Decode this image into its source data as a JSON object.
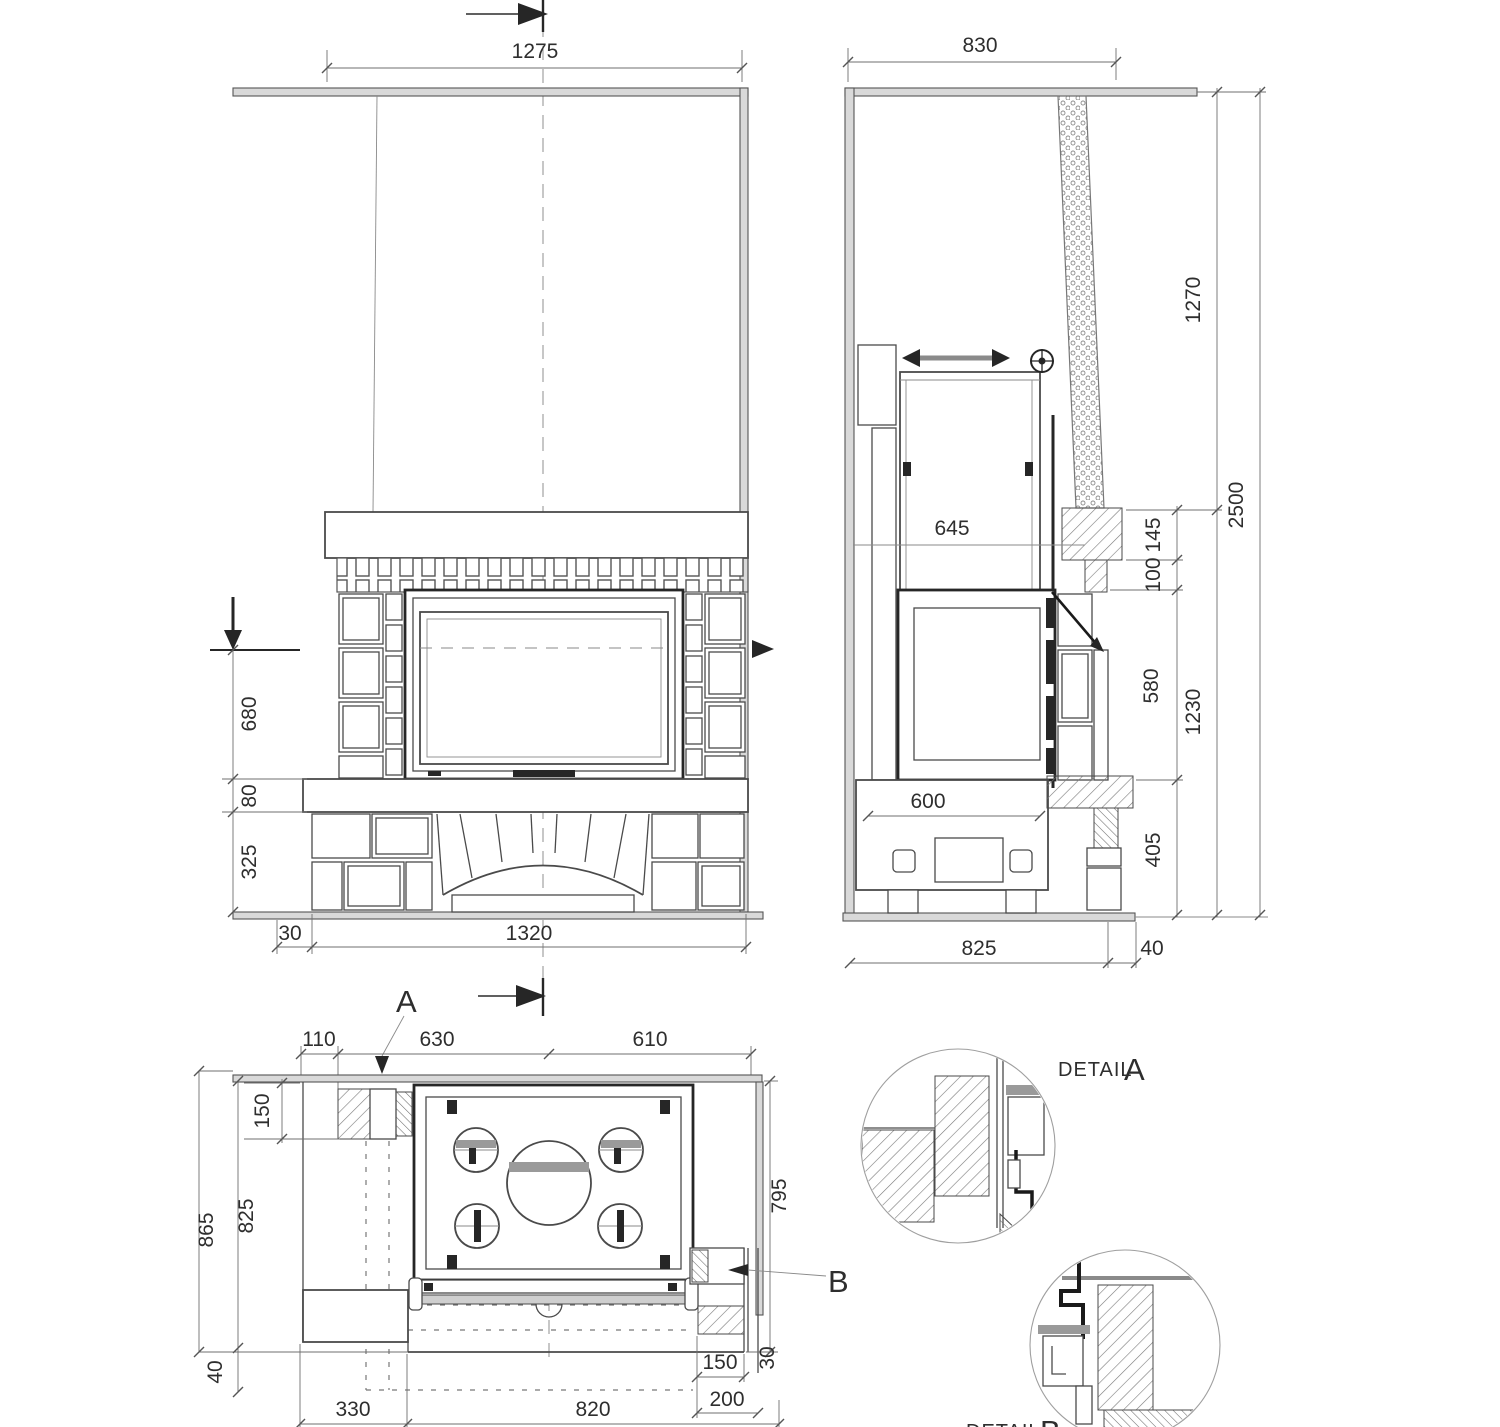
{
  "front_view": {
    "dim_top_width": "1275",
    "dim_firebox_height": "680",
    "dim_hearth_thickness": "80",
    "dim_base_height": "325",
    "dim_side_gap": "30",
    "dim_body_width": "1320"
  },
  "side_view": {
    "dim_top_depth": "830",
    "dim_upper_height": "1270",
    "dim_total_height": "2500",
    "dim_inner_depth": "645",
    "dim_lintel_height": "145",
    "dim_gap_height": "100",
    "dim_firebox_height": "580",
    "dim_lower_height": "1230",
    "dim_base_depth": "600",
    "dim_base_height": "405",
    "dim_bottom_depth": "825",
    "dim_wall_thickness": "40"
  },
  "plan_view": {
    "label_section_a": "A",
    "label_section_b": "B",
    "dim_left_offset": "110",
    "dim_left_half": "630",
    "dim_right_half": "610",
    "dim_pier_depth": "150",
    "dim_total_depth": "865",
    "dim_inner_depth": "825",
    "dim_wall_thickness": "40",
    "dim_right_depth": "795",
    "dim_edge_gap": "30",
    "dim_hearth_offset": "330",
    "dim_hearth_width": "820",
    "dim_corner_width": "150",
    "dim_corner_depth": "200"
  },
  "details": {
    "detail_a_word": "DETAIL",
    "detail_a_letter": "A",
    "detail_b_word": "DETAIL",
    "detail_b_letter": "B"
  }
}
